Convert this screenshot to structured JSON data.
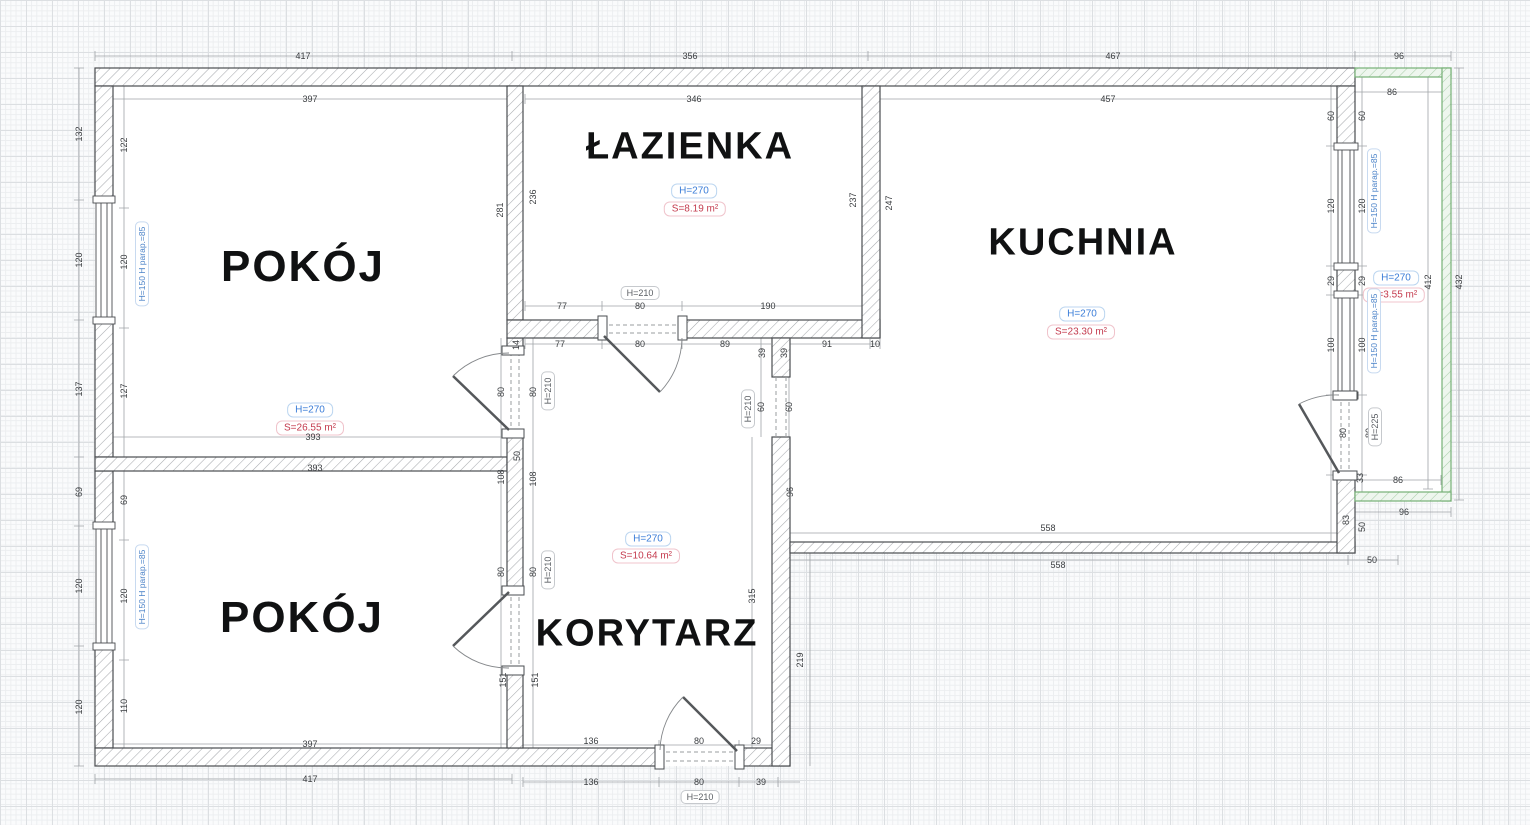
{
  "plan": {
    "rooms": {
      "pokoj_top": {
        "name": "POKÓJ",
        "height_label": "H=270",
        "area_label": "S=26.55 m²"
      },
      "lazienka": {
        "name": "ŁAZIENKA",
        "height_label": "H=270",
        "area_label": "S=8.19 m²"
      },
      "kuchnia": {
        "name": "KUCHNIA",
        "height_label": "H=270",
        "area_label": "S=23.30 m²"
      },
      "pokoj_bottom": {
        "name": "POKÓJ"
      },
      "korytarz": {
        "name": "KORYTARZ",
        "height_label": "H=270",
        "area_label": "S=10.64 m²"
      },
      "balkon": {
        "height_label": "H=270",
        "area_label": "S=3.55 m²"
      }
    },
    "colors": {
      "wall_outline": "#4a4d50",
      "wall_hatch": "#a8abaf",
      "balcony_outline": "#76b076",
      "balcony_hatch": "#a9cfa9",
      "dim_text": "#3a3d40",
      "height_badge": "#3b7dd8",
      "area_badge": "#c43b4e",
      "window_label": "#4a82c8"
    },
    "door_labels": [
      {
        "t": "H=210",
        "x": 640,
        "y": 293
      },
      {
        "t": "H=210",
        "x": 548,
        "y": 391,
        "r": 1
      },
      {
        "t": "H=210",
        "x": 548,
        "y": 570,
        "r": 1
      },
      {
        "t": "H=210",
        "x": 748,
        "y": 409,
        "r": 1
      },
      {
        "t": "H=210",
        "x": 700,
        "y": 797
      },
      {
        "t": "H=225",
        "x": 1375,
        "y": 427,
        "r": 1
      }
    ],
    "window_labels": [
      {
        "t": "H=150  H parap.=85",
        "x": 142,
        "y": 264
      },
      {
        "t": "H=150  H parap.=85",
        "x": 142,
        "y": 587
      },
      {
        "t": "H=150  H parap.=85",
        "x": 1374,
        "y": 191
      },
      {
        "t": "H=150  H parap.=85",
        "x": 1374,
        "y": 331
      }
    ],
    "dimensions": [
      {
        "t": "417",
        "x": 303,
        "y": 56
      },
      {
        "t": "356",
        "x": 690,
        "y": 56
      },
      {
        "t": "467",
        "x": 1113,
        "y": 56
      },
      {
        "t": "96",
        "x": 1399,
        "y": 56
      },
      {
        "t": "397",
        "x": 310,
        "y": 99
      },
      {
        "t": "346",
        "x": 694,
        "y": 99
      },
      {
        "t": "457",
        "x": 1108,
        "y": 99
      },
      {
        "t": "86",
        "x": 1392,
        "y": 92
      },
      {
        "t": "132",
        "x": 79,
        "y": 134,
        "r": 1
      },
      {
        "t": "120",
        "x": 79,
        "y": 260,
        "r": 1
      },
      {
        "t": "137",
        "x": 79,
        "y": 389,
        "r": 1
      },
      {
        "t": "69",
        "x": 79,
        "y": 492,
        "r": 1
      },
      {
        "t": "120",
        "x": 79,
        "y": 586,
        "r": 1
      },
      {
        "t": "120",
        "x": 79,
        "y": 707,
        "r": 1
      },
      {
        "t": "122",
        "x": 124,
        "y": 145,
        "r": 1
      },
      {
        "t": "120",
        "x": 124,
        "y": 262,
        "r": 1
      },
      {
        "t": "127",
        "x": 124,
        "y": 391,
        "r": 1
      },
      {
        "t": "69",
        "x": 124,
        "y": 500,
        "r": 1
      },
      {
        "t": "120",
        "x": 124,
        "y": 596,
        "r": 1
      },
      {
        "t": "110",
        "x": 124,
        "y": 706,
        "r": 1
      },
      {
        "t": "281",
        "x": 500,
        "y": 210,
        "r": 1
      },
      {
        "t": "236",
        "x": 533,
        "y": 197,
        "r": 1
      },
      {
        "t": "237",
        "x": 853,
        "y": 200,
        "r": 1
      },
      {
        "t": "247",
        "x": 889,
        "y": 203,
        "r": 1
      },
      {
        "t": "77",
        "x": 562,
        "y": 306
      },
      {
        "t": "80",
        "x": 640,
        "y": 306
      },
      {
        "t": "190",
        "x": 768,
        "y": 306
      },
      {
        "t": "77",
        "x": 560,
        "y": 344
      },
      {
        "t": "80",
        "x": 640,
        "y": 344
      },
      {
        "t": "89",
        "x": 725,
        "y": 344
      },
      {
        "t": "39",
        "x": 762,
        "y": 353,
        "r": 1
      },
      {
        "t": "39",
        "x": 784,
        "y": 353,
        "r": 1
      },
      {
        "t": "91",
        "x": 827,
        "y": 344
      },
      {
        "t": "10",
        "x": 875,
        "y": 344
      },
      {
        "t": "14",
        "x": 516,
        "y": 345,
        "r": 1
      },
      {
        "t": "80",
        "x": 501,
        "y": 392,
        "r": 1
      },
      {
        "t": "80",
        "x": 533,
        "y": 392,
        "r": 1
      },
      {
        "t": "50",
        "x": 517,
        "y": 456,
        "r": 1
      },
      {
        "t": "108",
        "x": 501,
        "y": 477,
        "r": 1
      },
      {
        "t": "108",
        "x": 533,
        "y": 479,
        "r": 1
      },
      {
        "t": "80",
        "x": 501,
        "y": 572,
        "r": 1
      },
      {
        "t": "80",
        "x": 533,
        "y": 572,
        "r": 1
      },
      {
        "t": "151",
        "x": 503,
        "y": 680,
        "r": 1
      },
      {
        "t": "151",
        "x": 535,
        "y": 680,
        "r": 1
      },
      {
        "t": "393",
        "x": 313,
        "y": 437
      },
      {
        "t": "393",
        "x": 315,
        "y": 468
      },
      {
        "t": "60",
        "x": 761,
        "y": 407,
        "r": 1
      },
      {
        "t": "60",
        "x": 789,
        "y": 407,
        "r": 1
      },
      {
        "t": "96",
        "x": 790,
        "y": 492,
        "r": 1
      },
      {
        "t": "315",
        "x": 752,
        "y": 596,
        "r": 1
      },
      {
        "t": "219",
        "x": 800,
        "y": 660,
        "r": 1
      },
      {
        "t": "60",
        "x": 1331,
        "y": 116,
        "r": 1
      },
      {
        "t": "120",
        "x": 1331,
        "y": 206,
        "r": 1
      },
      {
        "t": "29",
        "x": 1331,
        "y": 281,
        "r": 1
      },
      {
        "t": "100",
        "x": 1331,
        "y": 345,
        "r": 1
      },
      {
        "t": "80",
        "x": 1343,
        "y": 433,
        "r": 1
      },
      {
        "t": "83",
        "x": 1346,
        "y": 520,
        "r": 1
      },
      {
        "t": "60",
        "x": 1362,
        "y": 116,
        "r": 1
      },
      {
        "t": "120",
        "x": 1362,
        "y": 206,
        "r": 1
      },
      {
        "t": "29",
        "x": 1362,
        "y": 281,
        "r": 1
      },
      {
        "t": "100",
        "x": 1362,
        "y": 345,
        "r": 1
      },
      {
        "t": "80",
        "x": 1369,
        "y": 433,
        "r": 1
      },
      {
        "t": "33",
        "x": 1360,
        "y": 478,
        "r": 1
      },
      {
        "t": "50",
        "x": 1362,
        "y": 527,
        "r": 1
      },
      {
        "t": "86",
        "x": 1398,
        "y": 480
      },
      {
        "t": "96",
        "x": 1404,
        "y": 512
      },
      {
        "t": "412",
        "x": 1428,
        "y": 282,
        "r": 1
      },
      {
        "t": "432",
        "x": 1459,
        "y": 282,
        "r": 1
      },
      {
        "t": "558",
        "x": 1048,
        "y": 528
      },
      {
        "t": "558",
        "x": 1058,
        "y": 565
      },
      {
        "t": "50",
        "x": 1372,
        "y": 560
      },
      {
        "t": "397",
        "x": 310,
        "y": 744
      },
      {
        "t": "417",
        "x": 310,
        "y": 779
      },
      {
        "t": "136",
        "x": 591,
        "y": 741
      },
      {
        "t": "80",
        "x": 699,
        "y": 741
      },
      {
        "t": "29",
        "x": 756,
        "y": 741
      },
      {
        "t": "136",
        "x": 591,
        "y": 782
      },
      {
        "t": "80",
        "x": 699,
        "y": 782
      },
      {
        "t": "39",
        "x": 761,
        "y": 782
      }
    ]
  }
}
